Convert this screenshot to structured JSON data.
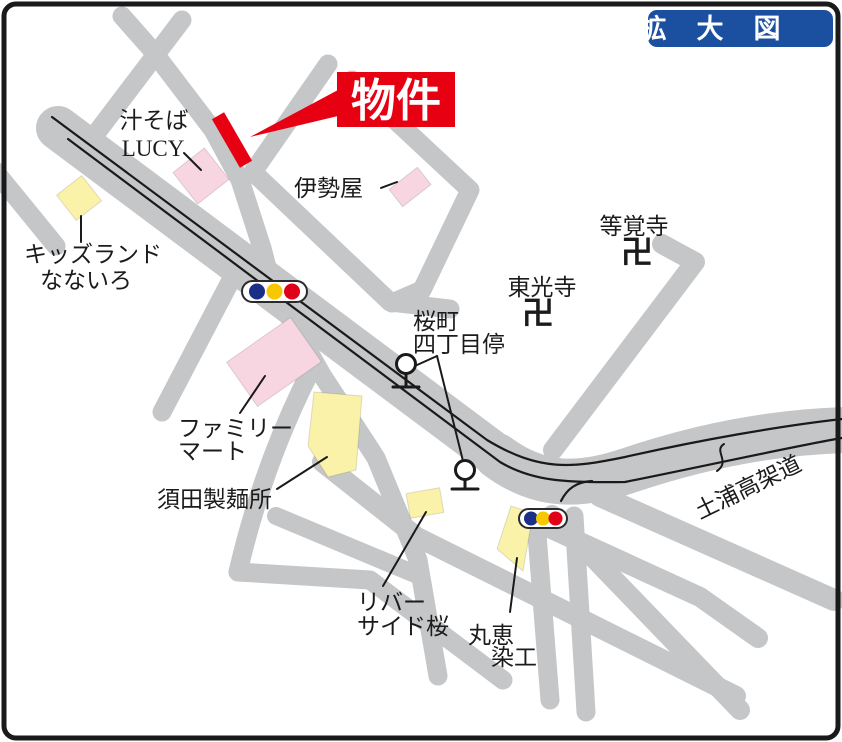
{
  "badge": {
    "label": "拡大図"
  },
  "property_banner": {
    "label": "物件"
  },
  "landmarks": {
    "lucy": {
      "line1": "汁そば",
      "line2": "LUCY"
    },
    "kidsland": {
      "line1": "キッズランド",
      "line2": "なないろ"
    },
    "iseya": {
      "label": "伊勢屋"
    },
    "tokakuji": {
      "label": "等覚寺",
      "icon": "卍"
    },
    "tokoji": {
      "label": "東光寺",
      "icon": "卍"
    },
    "bus_stop": {
      "line1": "桜町",
      "line2": "四丁目停"
    },
    "familymart": {
      "line1": "ファミリー",
      "line2": "マート"
    },
    "suda": {
      "label": "須田製麺所"
    },
    "riverside": {
      "line1": "リバー",
      "line2": "サイド桜"
    },
    "marue": {
      "line1": "丸恵",
      "line2": "染工"
    },
    "viaduct": {
      "label": "土浦高架道"
    }
  },
  "colors": {
    "background": "#ffffff",
    "border": "#1a1a1a",
    "road": "#c5c6c8",
    "road_line": "#1a1a1a",
    "building_pink": "#f7d5e1",
    "building_yellow": "#faf2a8",
    "accent_red": "#e60012",
    "badge_blue": "#1b4fa0",
    "signal_blue": "#1c2f87",
    "signal_yellow": "#f5c800",
    "signal_red": "#e00019",
    "text": "#1b1b1b"
  }
}
